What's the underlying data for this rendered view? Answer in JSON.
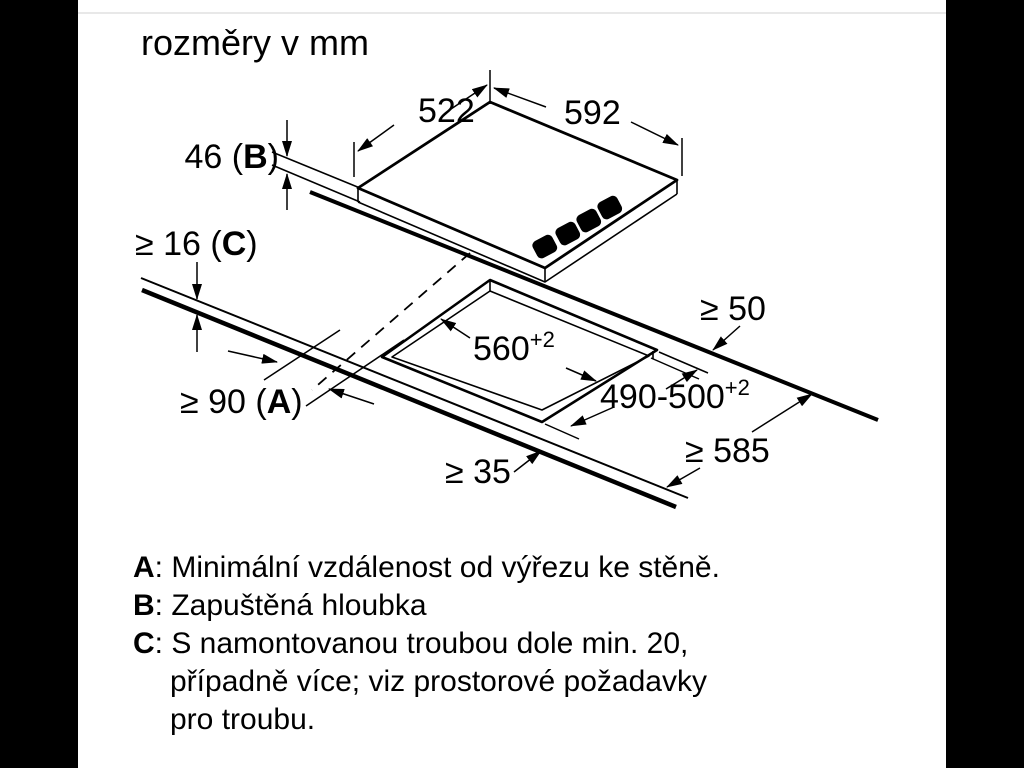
{
  "page": {
    "background": "#000000",
    "panel_background": "#ffffff",
    "hairline_color": "#e8e8e8"
  },
  "title": "rozměry v mm",
  "diagram": {
    "type": "appliance-installation-dimension-drawing",
    "units": "mm",
    "labels": {
      "width": "522",
      "depth": "592",
      "recess_prefix": "46 (",
      "recess_key": "B",
      "recess_suffix": ")",
      "clearance_prefix": "≥ 16 (",
      "clearance_key": "C",
      "clearance_suffix": ")",
      "wall_prefix": "≥ 90 (",
      "wall_key": "A",
      "wall_suffix": ")",
      "cutout_width": "560",
      "cutout_width_tol": "+2",
      "cutout_depth": "490-500",
      "cutout_depth_tol": "+2",
      "rear_gap": "≥ 50",
      "worktop_depth": "≥ 585",
      "front_gap": "≥ 35"
    }
  },
  "legend": {
    "items": [
      {
        "key": "A",
        "text": ": Minimální vzdálenost od výřezu ke stěně."
      },
      {
        "key": "B",
        "text": ": Zapuštěná hloubka"
      },
      {
        "key": "C",
        "text": ": S namontovanou troubou dole min. 20,",
        "extra_lines": [
          "případně více; viz prostorové požadavky",
          "pro troubu."
        ]
      }
    ]
  }
}
